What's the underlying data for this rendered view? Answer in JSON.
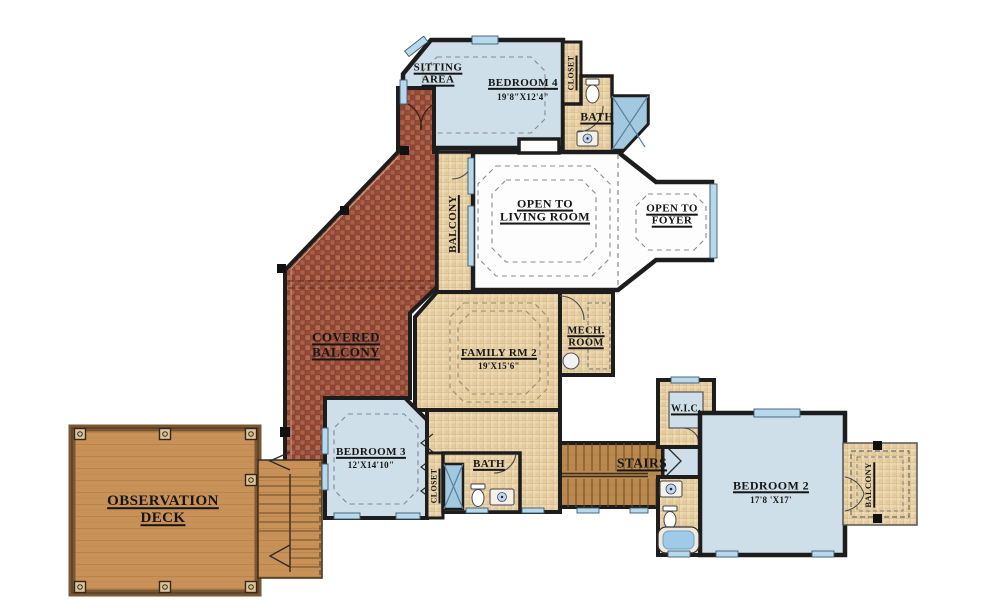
{
  "colors": {
    "wall": "#1d1d1d",
    "floor_blue": "#cedfe9",
    "tile_tan": "#e9d4ab",
    "brick_red": "#a0523f",
    "deck_wood": "#c89157",
    "stair_wood": "#b9894f",
    "window_glass": "#b8d9ec",
    "shower_blue": "#a3c9e0",
    "white_room": "#fdfdfd"
  },
  "rooms": {
    "sitting_area": {
      "line1": "SITTING",
      "line2": "AREA"
    },
    "bedroom4": {
      "label": "BEDROOM 4",
      "dims": "19'8\"X12'4\""
    },
    "closet_bedroom4": {
      "label": "CLOSET"
    },
    "bath_upper": {
      "label": "BATH"
    },
    "balcony_upper": {
      "label": "BALCONY"
    },
    "open_to_living_room": {
      "line1": "OPEN TO",
      "line2": "LIVING ROOM"
    },
    "open_to_foyer": {
      "line1": "OPEN TO",
      "line2": "FOYER"
    },
    "covered_balcony": {
      "line1": "COVERED",
      "line2": "BALCONY"
    },
    "family_rm2": {
      "label": "FAMILY RM 2",
      "dims": "19'X15'6\""
    },
    "mech_room": {
      "line1": "MECH.",
      "line2": "ROOM"
    },
    "bedroom3": {
      "label": "BEDROOM 3",
      "dims": "12'X14'10\""
    },
    "closet_bedroom3": {
      "label": "CLOSET"
    },
    "bath_bedroom3": {
      "label": "BATH"
    },
    "stairs": {
      "label": "STAIRS"
    },
    "wic": {
      "label": "W.I.C."
    },
    "bedroom2": {
      "label": "BEDROOM 2",
      "dims": "17'8 'X17'"
    },
    "balcony_bedroom2": {
      "label": "BALCONY"
    },
    "observation_deck": {
      "line1": "OBSERVATION",
      "line2": "DECK"
    }
  }
}
